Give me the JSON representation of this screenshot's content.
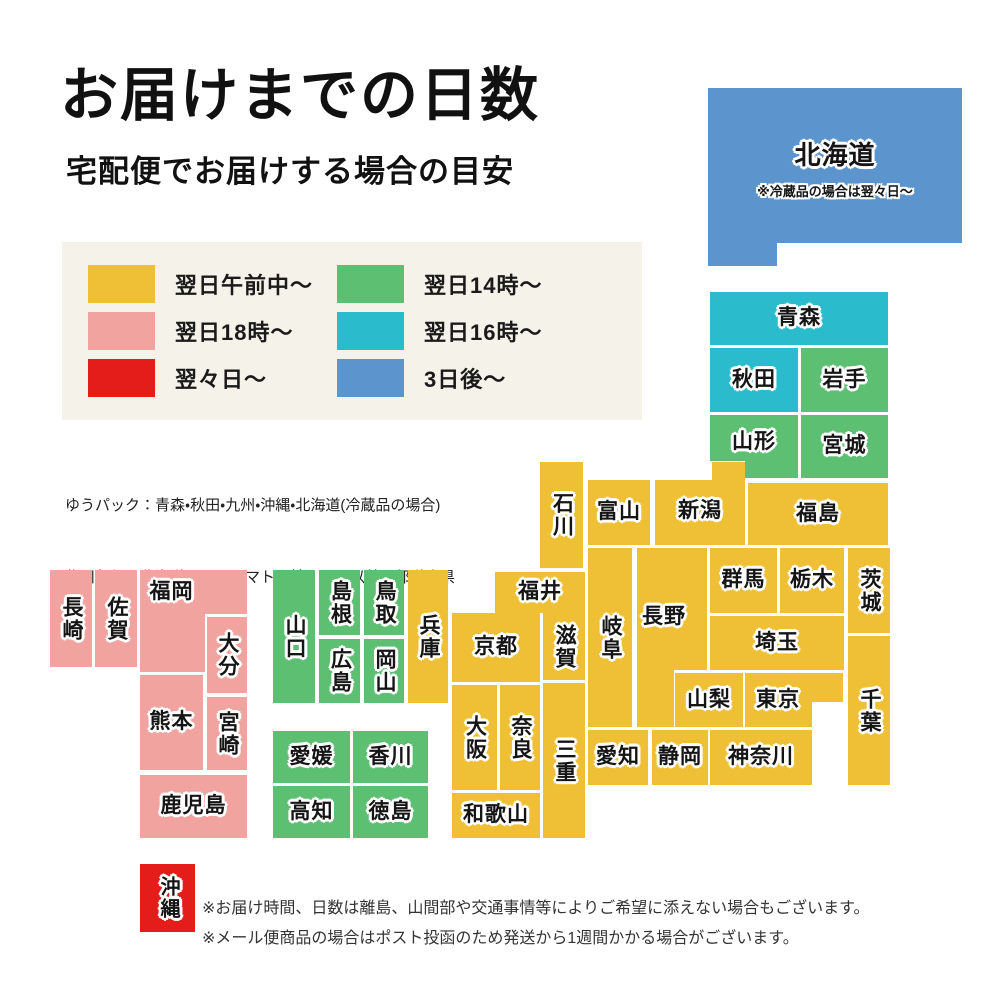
{
  "title": "お届けまでの日数",
  "subtitle": "宅配便でお届けする場合の目安",
  "colors": {
    "morning": "#efc035",
    "day14": "#5dbf72",
    "day18": "#f1a3a0",
    "day16": "#2abccd",
    "day2": "#e41d1a",
    "day3": "#5c94ce",
    "legend_bg": "#f5f2e9"
  },
  "legend": {
    "items": [
      {
        "key": "morning",
        "label": "翌日午前中〜"
      },
      {
        "key": "day14",
        "label": "翌日14時〜"
      },
      {
        "key": "day18",
        "label": "翌日18時〜"
      },
      {
        "key": "day16",
        "label": "翌日16時〜"
      },
      {
        "key": "day2",
        "label": "翌々日〜"
      },
      {
        "key": "day3",
        "label": "3日後〜"
      }
    ]
  },
  "notes": {
    "carrier": [
      "ゆうパック：青森・秋田・九州・沖縄・北海道(冷蔵品の場合)",
      "佐川急便：北海道　　　ヤマト運輸：それ以外の都道府県"
    ],
    "footer": [
      "※お届け時間、日数は離島、山間部や交通事情等によりご希望に添えない場合もございます。",
      "※メール便商品の場合はポスト投函のため発送から1週間かかる場合がございます。"
    ]
  },
  "map": {
    "prefectures": [
      {
        "id": "hokkaido",
        "name": "北海道",
        "color": "day3",
        "x": 708,
        "y": 88,
        "w": 254,
        "h": 178,
        "fs": 26,
        "clip": "polygon(0 0,254px 0,254px 155px,69px 155px,69px 178px,0 178px)",
        "note": "※冷蔵品の場合は翌々日〜",
        "dy": -6
      },
      {
        "id": "aomori",
        "name": "青森",
        "color": "day16",
        "x": 710,
        "y": 292,
        "w": 178,
        "h": 53
      },
      {
        "id": "akita",
        "name": "秋田",
        "color": "day16",
        "x": 710,
        "y": 348,
        "w": 88,
        "h": 64
      },
      {
        "id": "iwate",
        "name": "岩手",
        "color": "day14",
        "x": 801,
        "y": 348,
        "w": 87,
        "h": 64
      },
      {
        "id": "yamagata",
        "name": "山形",
        "color": "day14",
        "x": 710,
        "y": 415,
        "w": 88,
        "h": 63,
        "clip": "polygon(0 0,88px 0,88px 63px,35px 63px,35px 46px,0 46px)",
        "dy": -4
      },
      {
        "id": "miyagi",
        "name": "宮城",
        "color": "day14",
        "x": 801,
        "y": 415,
        "w": 87,
        "h": 63
      },
      {
        "id": "niigata",
        "name": "新潟",
        "color": "morning",
        "x": 655,
        "y": 462,
        "w": 90,
        "h": 83,
        "clip": "polygon(0 18px,57px 18px,57px 0,90px 0,90px 83px,0 83px)",
        "dy": 8
      },
      {
        "id": "ishikawa",
        "name": "石川",
        "color": "morning",
        "x": 540,
        "y": 462,
        "w": 43,
        "h": 106,
        "v": true
      },
      {
        "id": "toyama",
        "name": "富山",
        "color": "morning",
        "x": 588,
        "y": 480,
        "w": 62,
        "h": 65
      },
      {
        "id": "fukushima",
        "name": "福島",
        "color": "morning",
        "x": 748,
        "y": 483,
        "w": 140,
        "h": 62
      },
      {
        "id": "fukui",
        "name": "福井",
        "color": "morning",
        "x": 495,
        "y": 572,
        "w": 90,
        "h": 41
      },
      {
        "id": "gifu",
        "name": "岐阜",
        "color": "morning",
        "x": 588,
        "y": 548,
        "w": 44,
        "h": 179,
        "v": true
      },
      {
        "id": "nagano",
        "name": "長野",
        "color": "morning",
        "x": 637,
        "y": 548,
        "w": 70,
        "h": 179,
        "clip": "polygon(0 0,70px 0,70px 122px,37px 122px,37px 179px,0 179px)",
        "dx": -8,
        "dy": -20
      },
      {
        "id": "gunma",
        "name": "群馬",
        "color": "morning",
        "x": 710,
        "y": 548,
        "w": 67,
        "h": 65
      },
      {
        "id": "tochigi",
        "name": "栃木",
        "color": "morning",
        "x": 780,
        "y": 548,
        "w": 64,
        "h": 65
      },
      {
        "id": "ibaraki",
        "name": "茨城",
        "color": "morning",
        "x": 848,
        "y": 548,
        "w": 42,
        "h": 85,
        "v": true
      },
      {
        "id": "saitama",
        "name": "埼玉",
        "color": "morning",
        "x": 710,
        "y": 616,
        "w": 134,
        "h": 54
      },
      {
        "id": "yamanashi",
        "name": "山梨",
        "color": "morning",
        "x": 675,
        "y": 673,
        "w": 68,
        "h": 54
      },
      {
        "id": "tokyo",
        "name": "東京",
        "color": "morning",
        "x": 745,
        "y": 673,
        "w": 98,
        "h": 54,
        "clip": "polygon(0 0,98px 0,98px 29px,67px 29px,67px 54px,0 54px)",
        "dx": -16
      },
      {
        "id": "chiba",
        "name": "千葉",
        "color": "morning",
        "x": 848,
        "y": 636,
        "w": 42,
        "h": 149,
        "v": true
      },
      {
        "id": "kanagawa",
        "name": "神奈川",
        "color": "morning",
        "x": 710,
        "y": 730,
        "w": 102,
        "h": 55
      },
      {
        "id": "shizuoka",
        "name": "静岡",
        "color": "morning",
        "x": 652,
        "y": 730,
        "w": 56,
        "h": 55
      },
      {
        "id": "aichi",
        "name": "愛知",
        "color": "morning",
        "x": 588,
        "y": 730,
        "w": 60,
        "h": 55
      },
      {
        "id": "hyogo",
        "name": "兵庫",
        "color": "morning",
        "x": 408,
        "y": 570,
        "w": 40,
        "h": 133,
        "v": true
      },
      {
        "id": "kyoto",
        "name": "京都",
        "color": "morning",
        "x": 452,
        "y": 613,
        "w": 88,
        "h": 69
      },
      {
        "id": "shiga",
        "name": "滋賀",
        "color": "morning",
        "x": 543,
        "y": 613,
        "w": 42,
        "h": 67,
        "v": true
      },
      {
        "id": "osaka",
        "name": "大阪",
        "color": "morning",
        "x": 452,
        "y": 685,
        "w": 45,
        "h": 105,
        "v": true
      },
      {
        "id": "nara",
        "name": "奈良",
        "color": "morning",
        "x": 500,
        "y": 685,
        "w": 40,
        "h": 105,
        "v": true
      },
      {
        "id": "mie",
        "name": "三重",
        "color": "morning",
        "x": 543,
        "y": 683,
        "w": 42,
        "h": 155,
        "v": true
      },
      {
        "id": "wakayama",
        "name": "和歌山",
        "color": "morning",
        "x": 452,
        "y": 793,
        "w": 88,
        "h": 45
      },
      {
        "id": "tottori",
        "name": "鳥取",
        "color": "day14",
        "x": 364,
        "y": 570,
        "w": 40,
        "h": 65,
        "v": true
      },
      {
        "id": "shimane",
        "name": "島根",
        "color": "day14",
        "x": 319,
        "y": 570,
        "w": 41,
        "h": 65,
        "v": true
      },
      {
        "id": "okayama",
        "name": "岡山",
        "color": "day14",
        "x": 364,
        "y": 639,
        "w": 40,
        "h": 64,
        "v": true
      },
      {
        "id": "hiroshima",
        "name": "広島",
        "color": "day14",
        "x": 319,
        "y": 639,
        "w": 41,
        "h": 64,
        "v": true
      },
      {
        "id": "yamaguchi",
        "name": "山口",
        "color": "day14",
        "x": 273,
        "y": 570,
        "w": 42,
        "h": 133,
        "v": true
      },
      {
        "id": "kagawa",
        "name": "香川",
        "color": "day14",
        "x": 353,
        "y": 731,
        "w": 75,
        "h": 52
      },
      {
        "id": "ehime",
        "name": "愛媛",
        "color": "day14",
        "x": 273,
        "y": 731,
        "w": 77,
        "h": 52
      },
      {
        "id": "tokushima",
        "name": "徳島",
        "color": "day14",
        "x": 353,
        "y": 786,
        "w": 75,
        "h": 52
      },
      {
        "id": "kochi",
        "name": "高知",
        "color": "day14",
        "x": 273,
        "y": 786,
        "w": 77,
        "h": 52
      },
      {
        "id": "fukuoka",
        "name": "福岡",
        "color": "day18",
        "x": 140,
        "y": 570,
        "w": 107,
        "h": 102,
        "clip": "polygon(0 0,107px 0,107px 44px,65px 44px,65px 102px,0 102px)",
        "dx": -22,
        "dy": -29
      },
      {
        "id": "saga",
        "name": "佐賀",
        "color": "day18",
        "x": 95,
        "y": 570,
        "w": 42,
        "h": 97,
        "v": true
      },
      {
        "id": "nagasaki",
        "name": "長崎",
        "color": "day18",
        "x": 50,
        "y": 570,
        "w": 42,
        "h": 97,
        "v": true
      },
      {
        "id": "oita",
        "name": "大分",
        "color": "day18",
        "x": 207,
        "y": 617,
        "w": 40,
        "h": 76,
        "v": true
      },
      {
        "id": "kumamoto",
        "name": "熊本",
        "color": "day18",
        "x": 140,
        "y": 675,
        "w": 63,
        "h": 95
      },
      {
        "id": "miyazaki",
        "name": "宮崎",
        "color": "day18",
        "x": 207,
        "y": 697,
        "w": 40,
        "h": 73,
        "v": true
      },
      {
        "id": "kagoshima",
        "name": "鹿児島",
        "color": "day18",
        "x": 140,
        "y": 775,
        "w": 107,
        "h": 63
      },
      {
        "id": "okinawa",
        "name": "沖縄",
        "color": "day2",
        "x": 140,
        "y": 864,
        "w": 55,
        "h": 68,
        "v": true,
        "fs": 20
      }
    ]
  }
}
